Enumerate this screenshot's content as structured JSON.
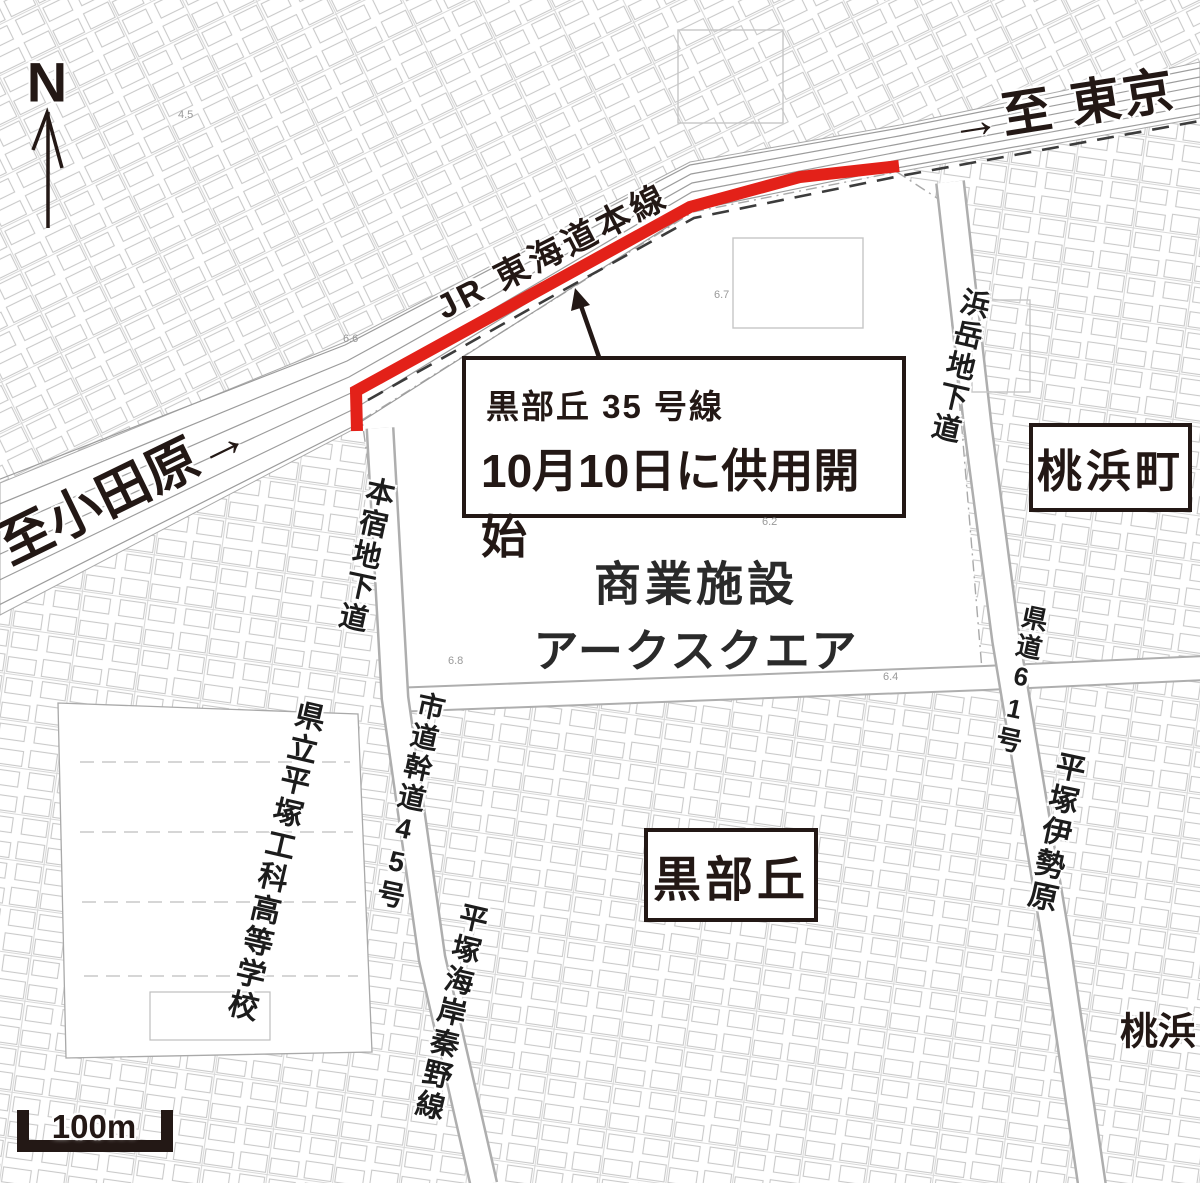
{
  "map": {
    "compass": {
      "label": "N"
    },
    "directions": {
      "to_tokyo": "→至 東京",
      "to_odawara": "至小田原→"
    },
    "railway": {
      "label": "JR 東海道本線"
    },
    "callout": {
      "road_name": "黒部丘 35 号線",
      "notice": "10月10日に供用開始"
    },
    "facility": {
      "line1": "商業施設",
      "line2": "アークスクエア"
    },
    "districts": {
      "momohama_cho": "桃浜町",
      "kurobegaoka": "黒部丘",
      "momohama": "桃浜"
    },
    "roads": {
      "honjuku_underpass": "本宿地下道",
      "hamatake_underpass": "浜岳地下道",
      "city_road_no": "市道幹道45号",
      "city_road_name": "平塚海岸秦野線",
      "pref_road_no": "県道61号",
      "pref_road_name": "平塚伊勢原"
    },
    "landmarks": {
      "school": "県立平塚工科高等学校"
    },
    "scale": {
      "label": "100m"
    },
    "spot_elevations": [
      "4.5",
      "6.6",
      "6.7",
      "6.2",
      "6.8",
      "6.4"
    ],
    "colors": {
      "highlight_red": "#e32119",
      "ink": "#231815"
    }
  }
}
